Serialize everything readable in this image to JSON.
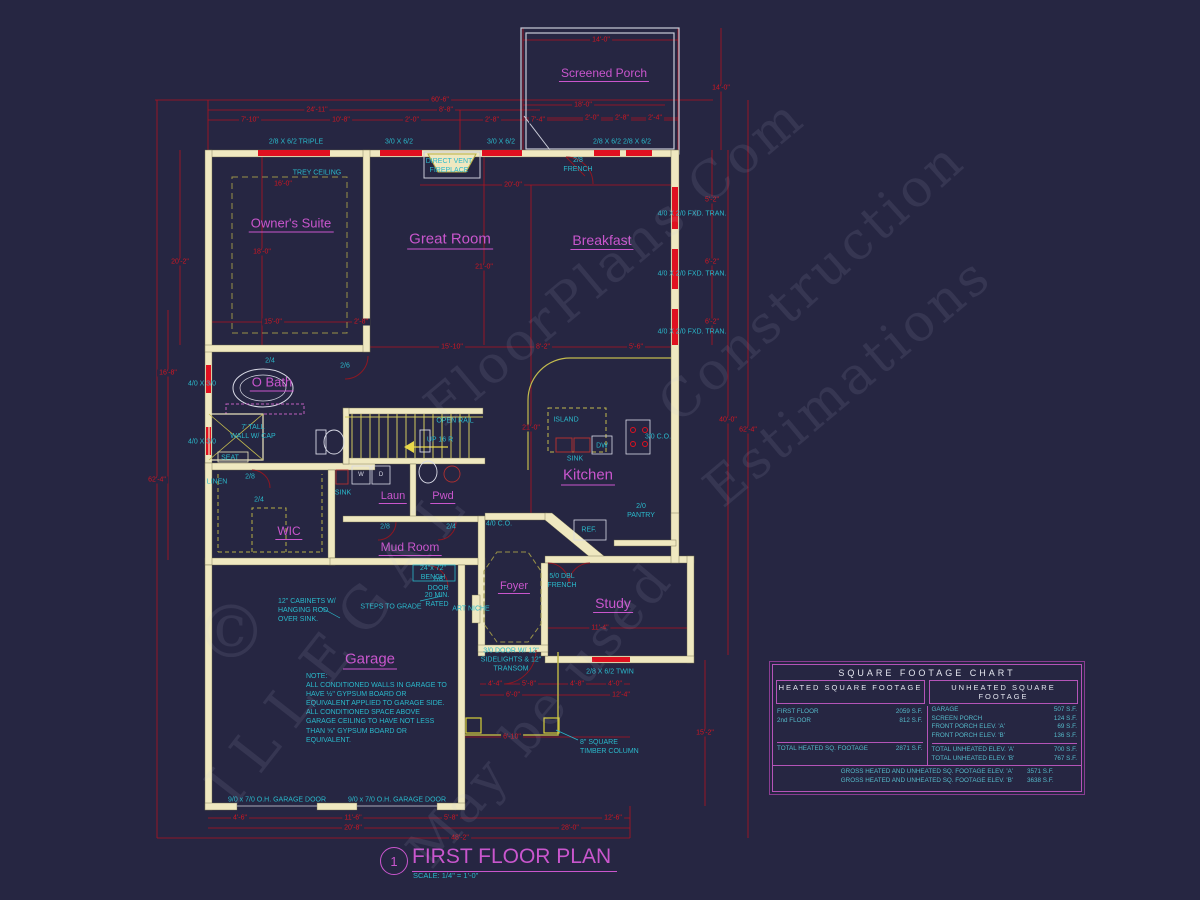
{
  "title_block": {
    "number": "1",
    "title": "FIRST FLOOR PLAN",
    "scale": "SCALE: 1/4\" = 1'-0\""
  },
  "watermark": {
    "copyright": "©",
    "illegal": "ILLEGAL",
    "floorplans": "FloorPlans.Com",
    "construction": "Construction",
    "estimations": "Estimations",
    "may": "May be used"
  },
  "rooms": [
    {
      "label": "Screened Porch"
    },
    {
      "label": "Owner's Suite"
    },
    {
      "label": "Great Room"
    },
    {
      "label": "Breakfast"
    },
    {
      "label": "O Bath"
    },
    {
      "label": "WIC"
    },
    {
      "label": "Laun"
    },
    {
      "label": "Pwd"
    },
    {
      "label": "Mud Room"
    },
    {
      "label": "Kitchen"
    },
    {
      "label": "Foyer"
    },
    {
      "label": "Study"
    },
    {
      "label": "Garage"
    }
  ],
  "annotations": [
    {
      "text": "2/8 X 6/2 TRIPLE"
    },
    {
      "text": "3/0 X 6/2"
    },
    {
      "text": "3/0 X 6/2"
    },
    {
      "text": "2/8 X 6/2"
    },
    {
      "text": "2/8 X 6/2"
    },
    {
      "text": "DIRECT VENT\nFIREPLACE"
    },
    {
      "text": "2/8\nFRENCH"
    },
    {
      "text": "4/0 X 2/0 FXD. TRAN."
    },
    {
      "text": "4/0 X 2/0 FXD. TRAN."
    },
    {
      "text": "4/0 X 2/0 FXD. TRAN."
    },
    {
      "text": "TREY CEILING"
    },
    {
      "text": "4/0 X 3/0"
    },
    {
      "text": "4/0 X 3/0"
    },
    {
      "text": "7' TALL\nWALL W/ CAP"
    },
    {
      "text": "SEAT"
    },
    {
      "text": "LINEN"
    },
    {
      "text": "SINK"
    },
    {
      "text": "ISLAND"
    },
    {
      "text": "SINK"
    },
    {
      "text": "DW"
    },
    {
      "text": "REF."
    },
    {
      "text": "3/0 C.O."
    },
    {
      "text": "2/0\nPANTRY"
    },
    {
      "text": "OPEN RAIL"
    },
    {
      "text": "UP 16 R"
    },
    {
      "text": "4/0 C.O."
    },
    {
      "text": "24\"x 72\"\nBENCH"
    },
    {
      "text": "20 MIN.\nRATED"
    },
    {
      "text": "STEPS TO GRADE"
    },
    {
      "text": "12\" CABINETS W/\nHANGING ROD\nOVER SINK."
    },
    {
      "text": "ART NICHE"
    },
    {
      "text": "5/0 DBL\nFRENCH"
    },
    {
      "text": "3/0 DOOR W/ 12\"\nSIDELIGHTS & 12\"\nTRANSOM"
    },
    {
      "text": "2/8 X 6/2 TWIN"
    },
    {
      "text": "8\" SQUARE\nTIMBER COLUMN"
    },
    {
      "text": "9/0 x 7/0 O.H. GARAGE DOOR"
    },
    {
      "text": "9/0 x 7/0 O.H. GARAGE DOOR"
    },
    {
      "text": "2/4"
    },
    {
      "text": "2/6"
    },
    {
      "text": "2/8"
    },
    {
      "text": "2/4"
    },
    {
      "text": "2/8"
    },
    {
      "text": "2/4"
    },
    {
      "text": "2/8\nDOOR"
    }
  ],
  "fixtures": [
    {
      "text": "W"
    },
    {
      "text": "D"
    }
  ],
  "garage_note": "NOTE:\nALL CONDITIONED WALLS IN GARAGE TO\nHAVE ½\" GYPSUM BOARD OR\nEQUIVALENT APPLIED TO GARAGE SIDE.\nALL CONDITIONED SPACE ABOVE\nGARAGE CEILING TO HAVE NOT LESS\nTHAN ⅝\" GYPSUM BOARD OR\nEQUIVALENT.",
  "dims": [
    {
      "text": "60'-6\""
    },
    {
      "text": "24'-11\""
    },
    {
      "text": "8'-8\""
    },
    {
      "text": "7'-10\""
    },
    {
      "text": "10'-8\""
    },
    {
      "text": "2'-0\""
    },
    {
      "text": "2'-8\""
    },
    {
      "text": "7'-4\""
    },
    {
      "text": "14'-0\""
    },
    {
      "text": "18'-0\""
    },
    {
      "text": "2'-0\""
    },
    {
      "text": "2'-8\""
    },
    {
      "text": "2'-4\""
    },
    {
      "text": "14'-0\""
    },
    {
      "text": "16'-0\""
    },
    {
      "text": "20'-0\""
    },
    {
      "text": "18'-0\""
    },
    {
      "text": "21'-0\""
    },
    {
      "text": "15'-0\""
    },
    {
      "text": "2'-8\""
    },
    {
      "text": "15'-10\""
    },
    {
      "text": "8'-2\""
    },
    {
      "text": "5'-6\""
    },
    {
      "text": "5'-2\""
    },
    {
      "text": "6'-2\""
    },
    {
      "text": "6'-2\""
    },
    {
      "text": "40'-0\""
    },
    {
      "text": "62'-4\""
    },
    {
      "text": "20'-2\""
    },
    {
      "text": "16'-8\""
    },
    {
      "text": "62'-4\""
    },
    {
      "text": "4'-4\""
    },
    {
      "text": "5'-8\""
    },
    {
      "text": "4'-8\""
    },
    {
      "text": "4'-0\""
    },
    {
      "text": "6'-0\""
    },
    {
      "text": "12'-4\""
    },
    {
      "text": "6'-10\""
    },
    {
      "text": "11'-4\""
    },
    {
      "text": "4'-6\""
    },
    {
      "text": "11'-6\""
    },
    {
      "text": "5'-8\""
    },
    {
      "text": "12'-6\""
    },
    {
      "text": "20'-8\""
    },
    {
      "text": "28'-0\""
    },
    {
      "text": "48'-2\""
    },
    {
      "text": "15'-2\""
    },
    {
      "text": "21'-0\""
    }
  ],
  "sqft_chart": {
    "title": "SQUARE FOOTAGE CHART",
    "heated": {
      "header": "HEATED SQUARE FOOTAGE",
      "rows": [
        [
          "FIRST FLOOR",
          "2059 S.F."
        ],
        [
          "2nd FLOOR",
          "812 S.F."
        ]
      ],
      "total": [
        "TOTAL HEATED SQ. FOOTAGE",
        "2871 S.F."
      ]
    },
    "unheated": {
      "header": "UNHEATED SQUARE FOOTAGE",
      "rows": [
        [
          "GARAGE",
          "507 S.F."
        ],
        [
          "SCREEN PORCH",
          "124 S.F."
        ],
        [
          "FRONT PORCH ELEV. 'A'",
          "69 S.F."
        ],
        [
          "FRONT PORCH ELEV. 'B'",
          "136 S.F."
        ]
      ],
      "totals": [
        [
          "TOTAL UNHEATED ELEV. 'A'",
          "700 S.F."
        ],
        [
          "TOTAL UNHEATED ELEV. 'B'",
          "767 S.F."
        ]
      ]
    },
    "gross": [
      [
        "GROSS HEATED AND UNHEATED SQ. FOOTAGE ELEV. 'A'",
        "3571 S.F."
      ],
      [
        "GROSS HEATED AND UNHEATED SQ. FOOTAGE ELEV. 'B'",
        "3638 S.F."
      ]
    ]
  }
}
